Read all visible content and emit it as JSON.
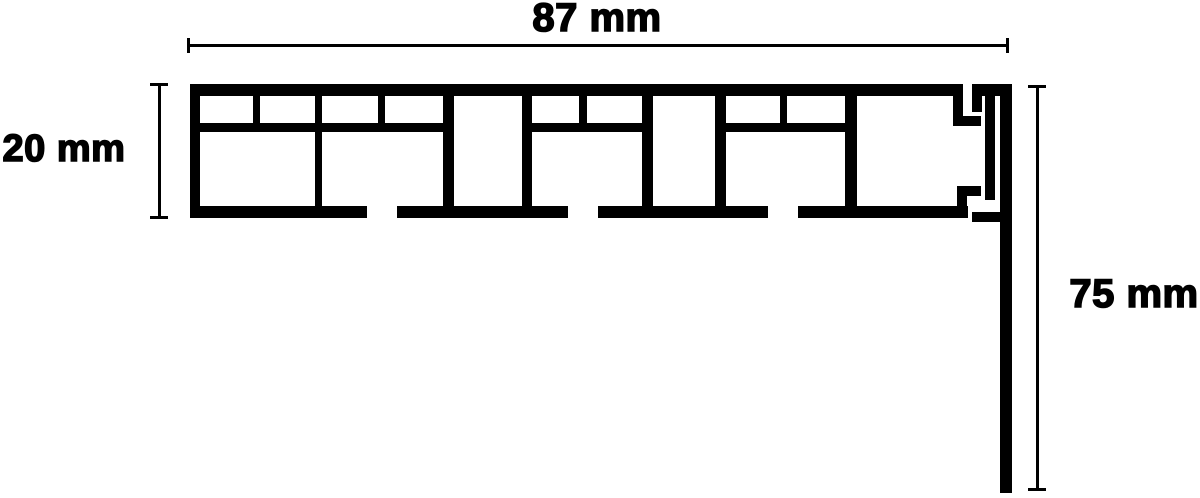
{
  "diagram": {
    "type": "technical-cross-section",
    "subject": "hollow-chamber profile cross-section with overhang and dimension callouts",
    "background_color": "#ffffff",
    "ink_color": "#000000",
    "dimensions": {
      "width": {
        "label": "87 mm",
        "value": 87,
        "unit": "mm"
      },
      "thickness": {
        "label": "20 mm",
        "value": 20,
        "unit": "mm"
      },
      "drop": {
        "label": "75 mm",
        "value": 75,
        "unit": "mm"
      }
    }
  }
}
